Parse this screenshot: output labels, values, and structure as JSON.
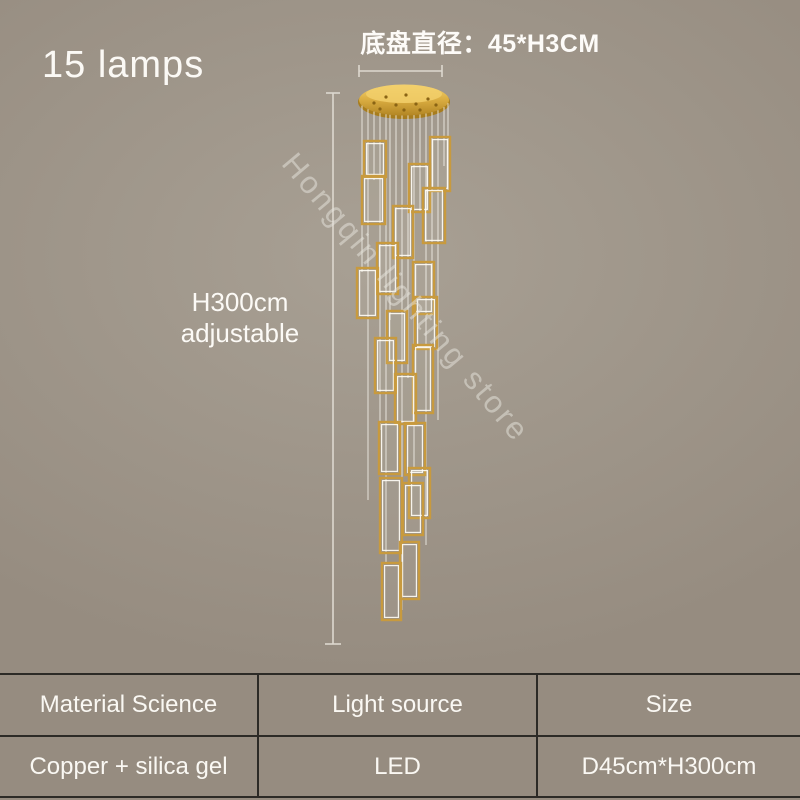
{
  "product": {
    "lamp_count_label": "15 lamps",
    "base_diameter_label": "底盘直径：45*H3CM",
    "height_label_line1": "H300cm",
    "height_label_line2": "adjustable",
    "watermark": "Hongqin lighting store"
  },
  "spec_table": {
    "columns": [
      {
        "header": "Material Science",
        "value": "Copper + silica gel"
      },
      {
        "header": "Light source",
        "value": "LED"
      },
      {
        "header": "Size",
        "value": "D45cm*H300cm"
      }
    ]
  },
  "colors": {
    "background": "#9e9589",
    "text": "#faf8f3",
    "gold_frame": "#c89a3e",
    "canopy_gold": "#d4a437",
    "table_border": "#2c2a26",
    "dimension_line": "#ddd8cf"
  }
}
